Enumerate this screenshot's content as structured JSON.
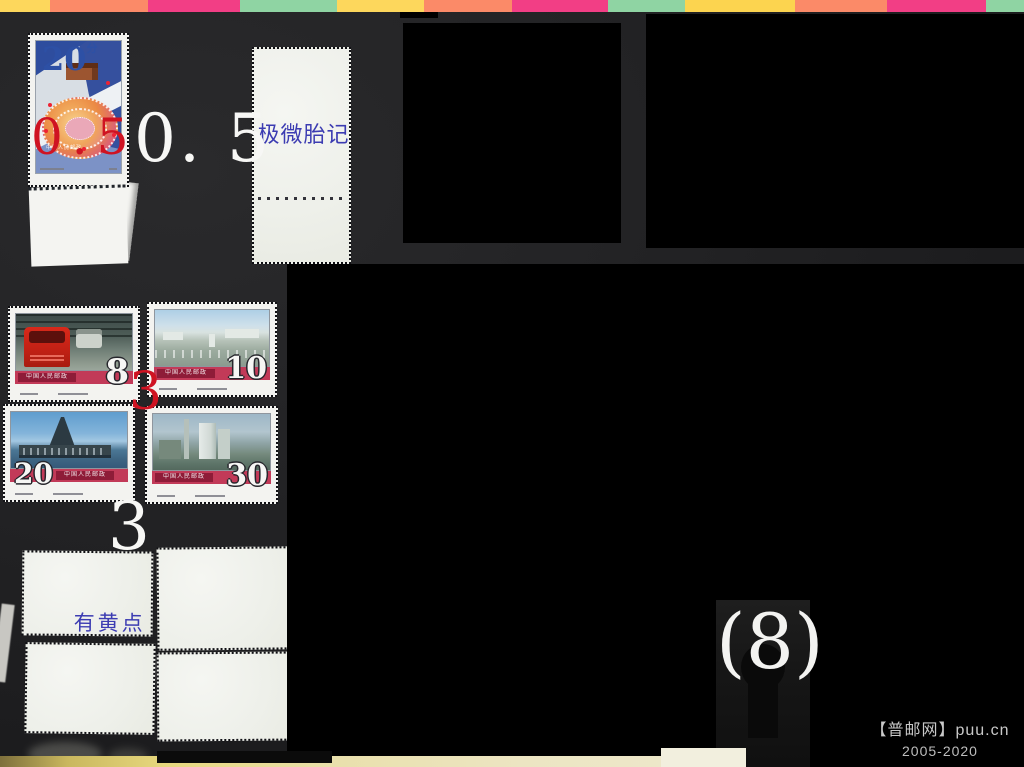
{
  "top_strip": {
    "segments": [
      {
        "style": "left:0px;width:50px;background:#fdd75c"
      },
      {
        "style": "left:50px;width:98px;background:#fb8a68"
      },
      {
        "style": "left:148px;width:92px;background:#f23e85"
      },
      {
        "style": "left:240px;width:97px;background:#8fd4a3"
      },
      {
        "style": "left:337px;width:87px;background:#fdd75c"
      },
      {
        "style": "left:424px;width:88px;background:#fb8a68"
      },
      {
        "style": "left:512px;width:96px;background:#f23e85"
      },
      {
        "style": "left:608px;width:77px;background:#8fd4a3"
      },
      {
        "style": "left:685px;width:110px;background:#fcd44f"
      },
      {
        "style": "left:795px;width:92px;background:#fb8a68"
      },
      {
        "style": "left:887px;width:99px;background:#f23e85"
      },
      {
        "style": "left:986px;width:38px;background:#8fd4a3"
      }
    ]
  },
  "film_stamp": {
    "denomination": "20",
    "unit": "分",
    "country_text": "中国人民邮政"
  },
  "stamp_block": {
    "country_text": "中国人民邮政",
    "stamps": [
      {
        "denomination": "8",
        "subject": "red-truck-assembly-line"
      },
      {
        "denomination": "10",
        "subject": "industrial-city-panorama"
      },
      {
        "denomination": "20",
        "subject": "offshore-oil-platform"
      },
      {
        "denomination": "30",
        "subject": "chemical-plant-towers"
      }
    ]
  },
  "annotations": {
    "film_stamp_price_red": "0.5",
    "film_stamp_price_white": "0. 5",
    "film_stamp_note": "极微胎记",
    "block_price_red": "3",
    "block_price_white": "3",
    "block_note": "有黄点",
    "count_label": "(8)",
    "red_color": "#cf1322",
    "blue_color": "#3c3cb2"
  },
  "watermark": {
    "line1": "【普邮网】puu.cn",
    "line2": "2005-2020",
    "color": "#c9c9c9"
  }
}
